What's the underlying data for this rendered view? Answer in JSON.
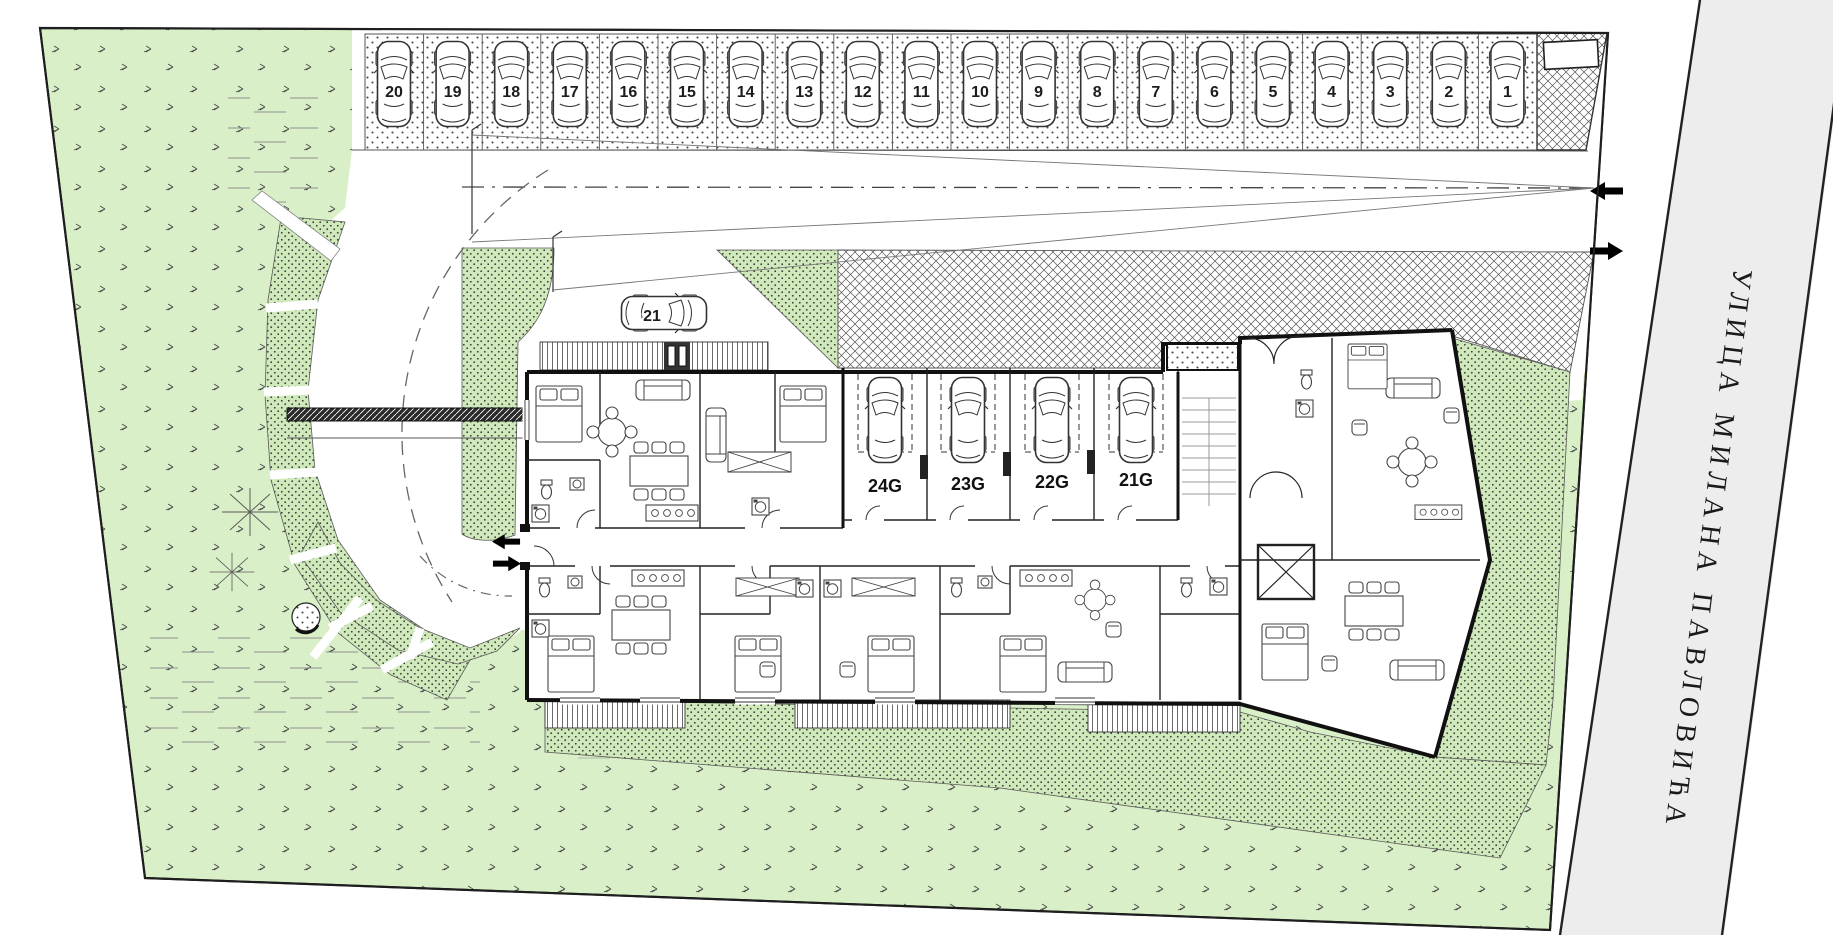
{
  "street": {
    "name": "УЛИЦА МИЛАНА ПАВЛОВИЋА"
  },
  "parking": {
    "spaces": [
      "20",
      "19",
      "18",
      "17",
      "16",
      "15",
      "14",
      "13",
      "12",
      "11",
      "10",
      "9",
      "8",
      "7",
      "6",
      "5",
      "4",
      "3",
      "2",
      "1"
    ]
  },
  "visitor_car": {
    "label": "21"
  },
  "garages": {
    "labels": [
      "24G",
      "23G",
      "22G",
      "21G"
    ]
  },
  "colors": {
    "lawn": "#d9efc8",
    "planting": "#cfe9bb",
    "street_fill": "#ededed",
    "outline": "#1e1e1e"
  }
}
